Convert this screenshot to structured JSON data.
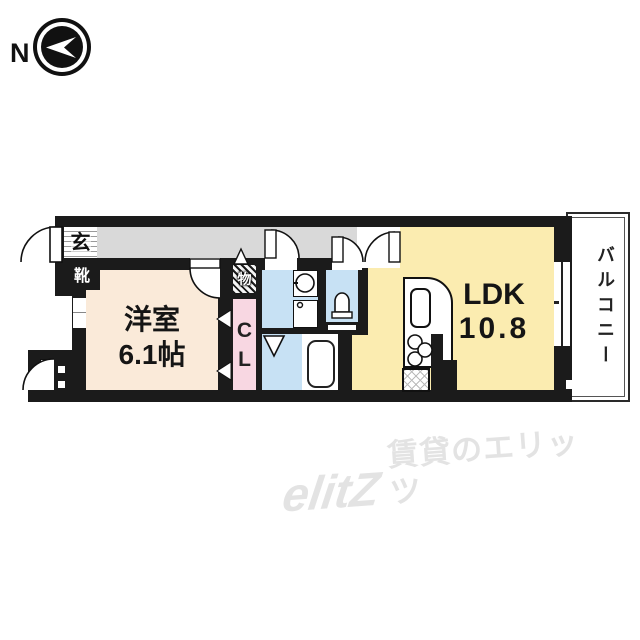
{
  "compass": {
    "north_label": "N"
  },
  "plan": {
    "genkan": {
      "label": "玄",
      "shoebox_label": "靴"
    },
    "storage_label": "物",
    "closet": {
      "line1": "C",
      "line2": "L"
    },
    "western_room": {
      "name": "洋室",
      "size": "6.1帖"
    },
    "ldk": {
      "name": "LDK",
      "size": "10.8"
    },
    "balcony_label": "バルコニー"
  },
  "watermark": {
    "logo": "elitZ",
    "text": "賃貸のエリッツ"
  },
  "colors": {
    "wall": "#1b1b1b",
    "hallway_gray": "#d9d9d9",
    "western_room_cream": "#faead9",
    "ldk_yellow": "#fbecb0",
    "closet_pink": "#f8d7e2",
    "wet_area_blue": "#c7e1f4",
    "watermark_gray": "#e3e3e3"
  }
}
